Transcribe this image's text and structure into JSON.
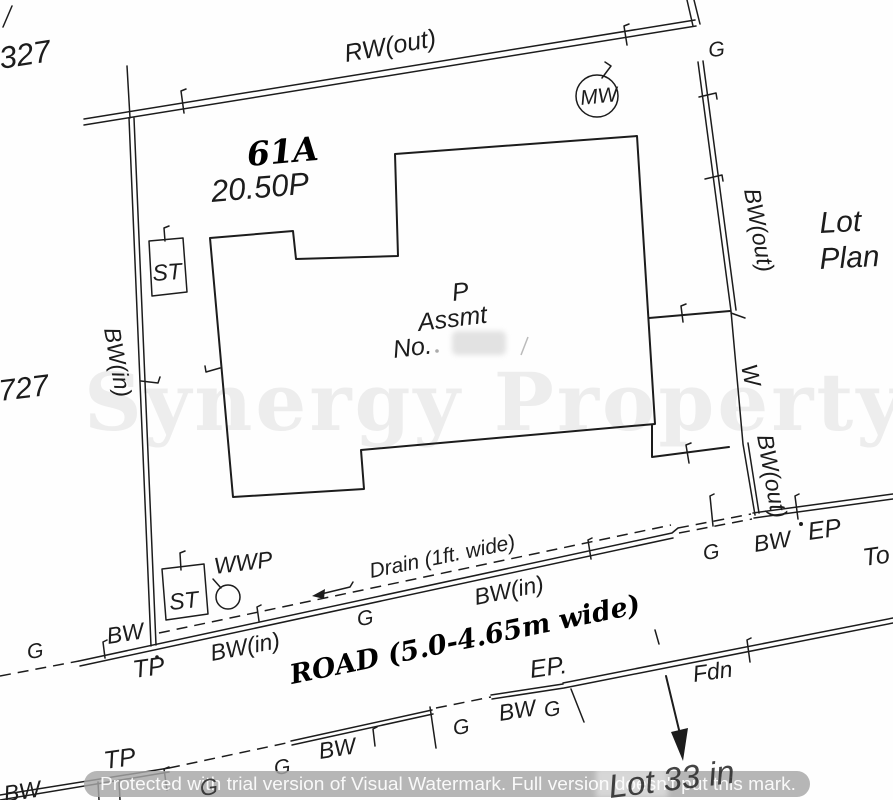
{
  "colors": {
    "ink": "#1c1c1c",
    "banner_gray": "#a6a6a6",
    "watermark_text": "#ffffff"
  },
  "labels": {
    "lot_top": "327",
    "rw_out": "RW(out)",
    "mw": "MW",
    "g_top": "G",
    "lot_number": "61A",
    "lot_area": "20.50P",
    "lot_word": "Lot",
    "plan_word": "Plan",
    "bw_out_upper": "BW(out)",
    "st_upper": "ST",
    "p": "P",
    "assmt": "Assmt",
    "no": "No.",
    "bw_in_west": "BW(in)",
    "lot_left": "727",
    "w": "W",
    "bw_out_lower": "BW(out)",
    "g_se": "G",
    "bw_se": "BW",
    "ep_se": "EP",
    "to": "To",
    "st_lower": "ST",
    "wwp": "WWP",
    "drain": "Drain  (1ft.  wide)",
    "bw_in_road": "BW(in)",
    "g_road": "G",
    "road": "ROAD  (5.0-4.65m  wide)",
    "g_west": "G",
    "bw_west": "BW",
    "tp_west": "TP",
    "bw_in_sw": "BW(in)",
    "ep_mid": "EP.",
    "fdn": "Fdn",
    "tp_south": "TP",
    "g_s1": "G",
    "g_s2": "G",
    "bw_s1": "BW",
    "g_s3": "G",
    "bw_s2": "BW",
    "g_s4": "G",
    "lot33": "Lot 33 in",
    "bw_corner": "BW"
  },
  "watermark": {
    "brand": "Synergy Property",
    "banner": "Protected with trial version of Visual Watermark. Full version doesn't put this mark."
  }
}
